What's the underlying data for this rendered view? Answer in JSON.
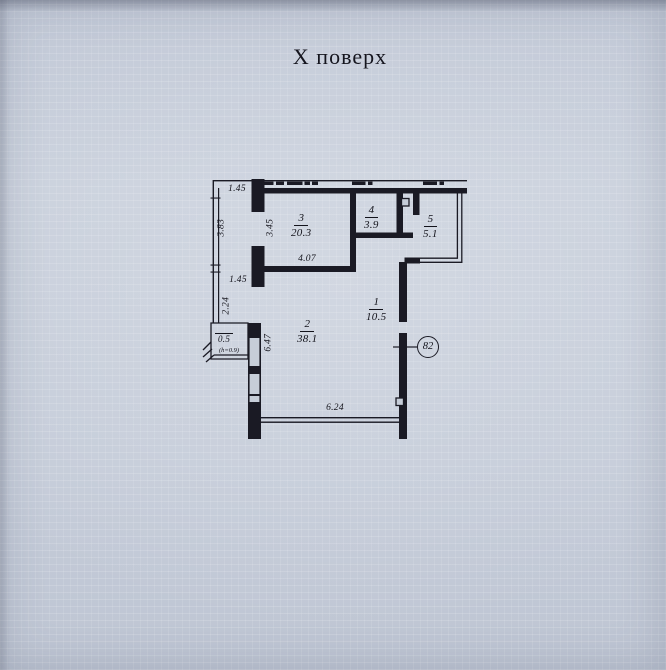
{
  "page": {
    "title": "Х поверх",
    "apartment_number": "82"
  },
  "rooms": {
    "room1": {
      "number": "1",
      "area": "10.5"
    },
    "room2": {
      "number": "2",
      "area": "38.1"
    },
    "room3": {
      "number": "3",
      "area": "20.3"
    },
    "room4": {
      "number": "4",
      "area": "3.9"
    },
    "room5": {
      "number": "5",
      "area": "5.1"
    },
    "niche": {
      "area": "0.5",
      "height_note": "(h=0.9)"
    }
  },
  "dimensions": {
    "top_left_width": "1.45",
    "left_window_upper": "3.83",
    "room3_left_height": "3.45",
    "mid_left_width": "1.45",
    "left_window_lower": "2.24",
    "room3_bottom_width": "4.07",
    "room2_left_height": "6.47",
    "bottom_width": "6.24"
  },
  "colors": {
    "paper": "#c6cdd8",
    "ink": "#1a1a24"
  }
}
